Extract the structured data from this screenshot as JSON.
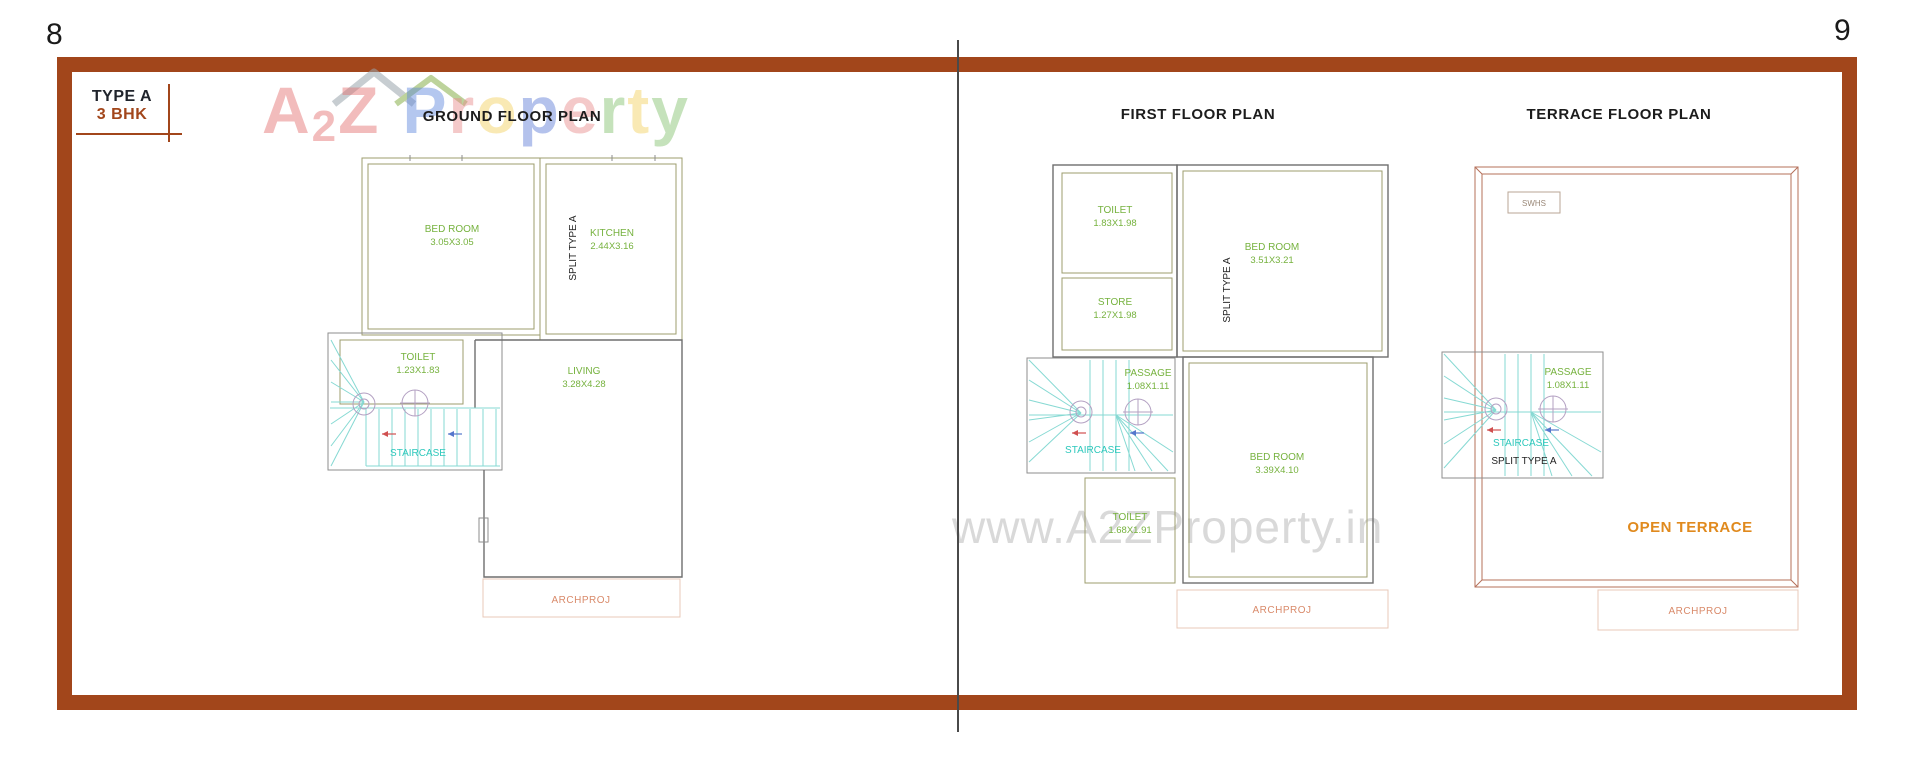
{
  "page": {
    "left_number": "8",
    "right_number": "9"
  },
  "type_badge": {
    "line1": "TYPE A",
    "line2": "3 BHK"
  },
  "brand": {
    "letters": [
      {
        "ch": "A"
      },
      {
        "ch": "2"
      },
      {
        "ch": "Z"
      },
      {
        "ch": "P"
      },
      {
        "ch": "r"
      },
      {
        "ch": "o"
      },
      {
        "ch": "p"
      },
      {
        "ch": "e"
      },
      {
        "ch": "r"
      },
      {
        "ch": "t"
      },
      {
        "ch": "y"
      }
    ]
  },
  "watermark_url": "www.A2ZProperty.in",
  "ground": {
    "title": "GROUND FLOOR PLAN",
    "bedroom_name": "BED ROOM",
    "bedroom_dim": "3.05X3.05",
    "kitchen_name": "KITCHEN",
    "kitchen_dim": "2.44X3.16",
    "split_label": "SPLIT TYPE A",
    "toilet_name": "TOILET",
    "toilet_dim": "1.23X1.83",
    "staircase_label": "STAIRCASE",
    "living_name": "LIVING",
    "living_dim": "3.28X4.28",
    "archproj": "ARCHPROJ"
  },
  "first": {
    "title": "FIRST FLOOR PLAN",
    "toilet1_name": "TOILET",
    "toilet1_dim": "1.83X1.98",
    "store_name": "STORE",
    "store_dim": "1.27X1.98",
    "bedroom1_name": "BED ROOM",
    "bedroom1_dim": "3.51X3.21",
    "split_label": "SPLIT TYPE A",
    "passage_name": "PASSAGE",
    "passage_dim": "1.08X1.11",
    "staircase_label": "STAIRCASE",
    "bedroom2_name": "BED ROOM",
    "bedroom2_dim": "3.39X4.10",
    "toilet2_name": "TOILET",
    "toilet2_dim": "1.68X1.91",
    "archproj": "ARCHPROJ"
  },
  "terrace": {
    "title": "TERRACE FLOOR PLAN",
    "swhs": "SWHS",
    "passage_name": "PASSAGE",
    "passage_dim": "1.08X1.11",
    "staircase_label": "STAIRCASE",
    "split_label": "SPLIT TYPE A",
    "open_terrace": "OPEN TERRACE",
    "archproj": "ARCHPROJ"
  },
  "colors": {
    "frame_brown": "#A2461B",
    "room_label_green": "#76B23E",
    "wall_olive": "#9C9C6E",
    "wall_dark": "#6E6E6E",
    "terrace_wall_salmon": "#B5705A",
    "stair_cyan": "#86D9D3",
    "stair_text_cyan": "#2EC8BC",
    "archproj_text": "#D98A6A",
    "open_terrace_orange": "#E08A1E",
    "url_watermark_gray": "#D9D9D9"
  }
}
